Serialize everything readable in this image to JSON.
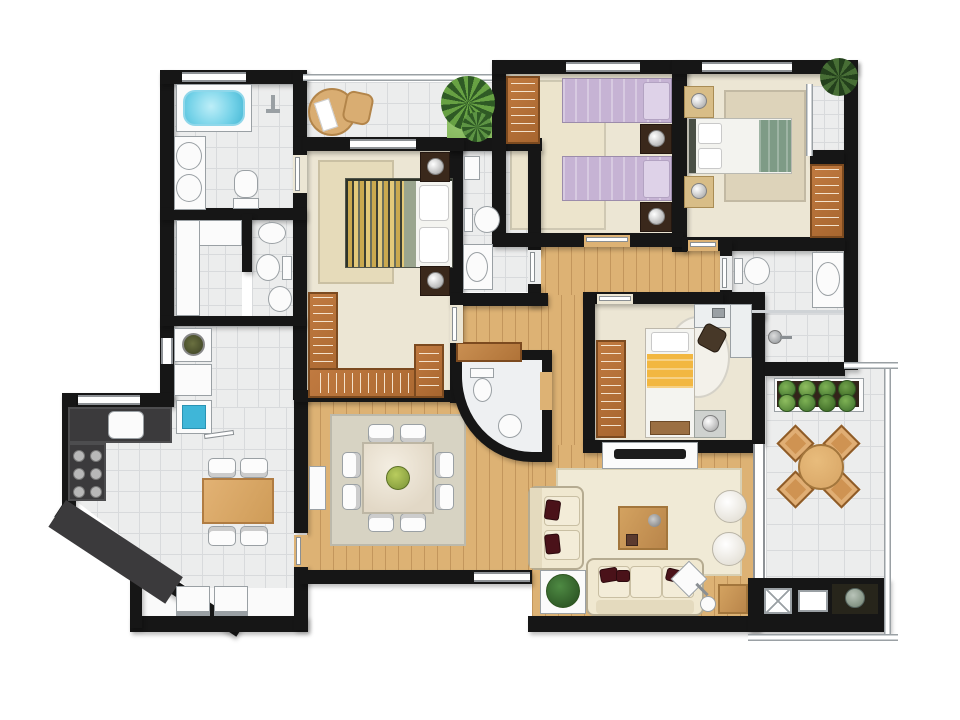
{
  "scene": {
    "type": "residential-apartment-floor-plan",
    "view": "top-down-rendered",
    "visible_text": "none"
  },
  "colors": {
    "wall": "#161616",
    "tile": "#eceded",
    "tile_line": "#d8dadc",
    "cream_floor": "#ece6d4",
    "wood_floor": "#ddb274",
    "wood_dark": "#b06f3a",
    "wood_edge": "#7c4a1f",
    "counter_dark": "#3b3a3c",
    "tub_blue": "#74d2e8",
    "laundry_blue": "#3fb6d8",
    "lavender": "#c6b3d4",
    "sage": "#7e9b86",
    "yellow": "#f2b741",
    "sofa_cream": "#f0e8d0",
    "pillow_red": "#4a1219",
    "rug_cream": "#f0ead6",
    "rug_tan": "#e6dbba",
    "rug_gray": "#d7d3c3",
    "plant_green": "#55873e",
    "grass": "#86b85e",
    "marble": "#eef0f2",
    "chair_tan": "#cf9352",
    "table_wood": "#dcab6b"
  },
  "rooms": [
    {
      "id": "master-bathroom",
      "floor": "tile",
      "fixtures": [
        "bathtub",
        "double-sinks",
        "toilet",
        "wall-shower"
      ]
    },
    {
      "id": "walk-in-closet",
      "floor": "tile",
      "fixtures": [
        "white-cabinets"
      ]
    },
    {
      "id": "wc",
      "floor": "tile",
      "fixtures": [
        "sink",
        "toilet",
        "bidet"
      ]
    },
    {
      "id": "service-area",
      "floor": "tile",
      "fixtures": [
        "washer",
        "dryer",
        "laundry-tank"
      ]
    },
    {
      "id": "kitchen",
      "floor": "tile",
      "fixtures": [
        "counter-sink",
        "stove-burners",
        "table-4-chairs",
        "fridge-freezer"
      ]
    },
    {
      "id": "master-balcony",
      "floor": "tile",
      "fixtures": [
        "lounge-chair",
        "ottoman",
        "palm-plant"
      ]
    },
    {
      "id": "master-bedroom",
      "floor": "cream",
      "fixtures": [
        "double-bed-striped",
        "2-nightstands",
        "rug",
        "u-shaped-closet"
      ]
    },
    {
      "id": "twin-bedroom",
      "floor": "cream",
      "fixtures": [
        "2-single-beds-lavender",
        "2-nightstands",
        "wardrobe",
        "rug"
      ]
    },
    {
      "id": "bedroom-3",
      "floor": "cream",
      "fixtures": [
        "double-bed-green",
        "2-nightstands",
        "wardrobe",
        "rug",
        "plant",
        "balconet"
      ]
    },
    {
      "id": "kids-bedroom",
      "floor": "cream",
      "fixtures": [
        "single-bed-yellow",
        "desk",
        "desk-chair",
        "round-rug",
        "wardrobe",
        "nightstand"
      ]
    },
    {
      "id": "bathroom-2",
      "floor": "tile",
      "fixtures": [
        "sink",
        "toilet",
        "counter-sink"
      ]
    },
    {
      "id": "bathroom-3",
      "floor": "tile",
      "fixtures": [
        "toilet",
        "counter-sink",
        "shower"
      ]
    },
    {
      "id": "powder-room",
      "floor": "marble",
      "fixtures": [
        "toilet",
        "round-sink",
        "curved-wall",
        "wood-shelf"
      ]
    },
    {
      "id": "hallway",
      "floor": "wood",
      "fixtures": []
    },
    {
      "id": "dining-room",
      "floor": "wood",
      "fixtures": [
        "square-table-8-chairs",
        "centerpiece",
        "rug",
        "sideboard"
      ]
    },
    {
      "id": "living-room",
      "floor": "wood",
      "fixtures": [
        "tv-console",
        "3-seat-sofa",
        "loveseat",
        "coffee-table",
        "2-poufs",
        "floor-lamp",
        "plant",
        "side-table",
        "rug"
      ]
    },
    {
      "id": "terrace",
      "floor": "tile",
      "fixtures": [
        "planter-box",
        "round-table-4-chairs"
      ]
    },
    {
      "id": "utility-core",
      "floor": "none",
      "fixtures": [
        "shaft-x-box",
        "duct-box",
        "planter"
      ]
    }
  ],
  "counts": {
    "bedrooms": 4,
    "bathrooms": 5,
    "dining_chairs": 8,
    "kitchen_chairs": 4,
    "terrace_chairs": 4,
    "planter_bushes": 8,
    "sofa_seats": 3,
    "poufs": 2
  }
}
